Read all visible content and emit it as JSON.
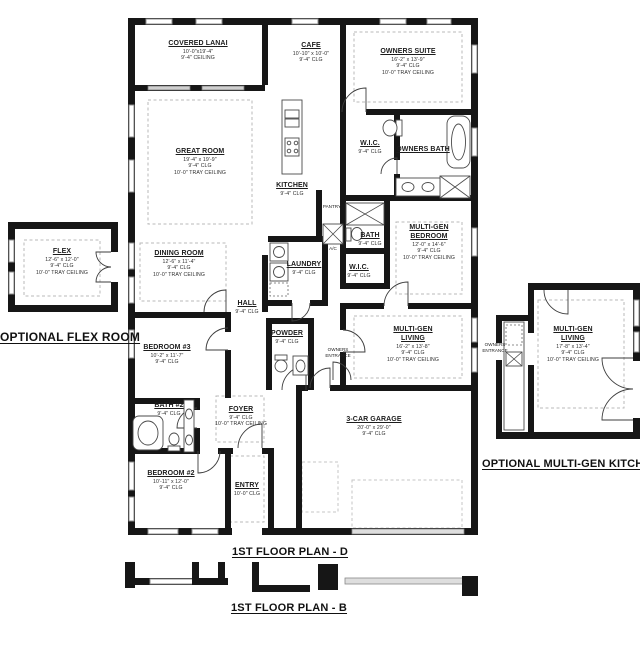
{
  "colors": {
    "wall": "#161616",
    "window_frame": "#8f8f8f",
    "dashed_tray": "#b9b9b9",
    "paper": "#ffffff"
  },
  "sections": {
    "optional_flex": "OPTIONAL FLEX ROOM",
    "optional_multigen_kitchen": "OPTIONAL MULTI-GEN KITCHEN",
    "plan_d": "1ST FLOOR PLAN - D",
    "plan_b": "1ST FLOOR PLAN - B"
  },
  "rooms": {
    "covered_lanai": {
      "name": "COVERED LANAI",
      "dims": "10'-0\"x19'-4\"",
      "clg": "9'-4\" CEILING"
    },
    "cafe": {
      "name": "CAFE",
      "dims": "10'-10\" x 10'-0\"",
      "clg": "9'-4\" CLG"
    },
    "owners_suite": {
      "name": "OWNERS SUITE",
      "dims": "16'-2\" x 13'-9\"",
      "clg": "9'-4\" CLG",
      "tray": "10'-0\" TRAY CEILING"
    },
    "great_room": {
      "name": "GREAT ROOM",
      "dims": "19'-4\" x 19'-9\"",
      "clg": "9'-4\" CLG",
      "tray": "10'-0\" TRAY CEILING"
    },
    "kitchen": {
      "name": "KITCHEN",
      "clg": "9'-4\" CLG"
    },
    "pantry": {
      "name": "PANTRY"
    },
    "owners_wic": {
      "name": "W.I.C.",
      "clg": "9'-4\" CLG"
    },
    "owners_bath": {
      "name": "OWNERS BATH"
    },
    "multigen_bedroom": {
      "name": "MULTI-GEN",
      "name2": "BEDROOM",
      "dims": "12'-0\" x 14'-6\"",
      "clg": "9'-4\" CLG",
      "tray": "10'-0\" TRAY CEILING"
    },
    "multigen_bath": {
      "name": "BATH",
      "clg": "9'-4\" CLG"
    },
    "multigen_wic": {
      "name": "W.I.C.",
      "clg": "9'-4\" CLG"
    },
    "dining_room": {
      "name": "DINING ROOM",
      "dims": "12'-6\" x 11'-4\"",
      "clg": "9'-4\" CLG",
      "tray": "10'-0\" TRAY CEILING"
    },
    "laundry": {
      "name": "LAUNDRY",
      "clg": "9'-4\" CLG"
    },
    "hall": {
      "name": "HALL",
      "clg": "9'-4\" CLG"
    },
    "powder": {
      "name": "POWDER",
      "clg": "9'-4\" CLG"
    },
    "owners_entrance": {
      "name": "OWNERS",
      "name2": "ENTRANCE"
    },
    "multigen_living": {
      "name": "MULTI-GEN",
      "name2": "LIVING",
      "dims": "16'-2\" x 13'-8\"",
      "clg": "9'-4\" CLG",
      "tray": "10'-0\" TRAY CEILING"
    },
    "bedroom3": {
      "name": "BEDROOM #3",
      "dims": "10'-2\" x 11'-7\"",
      "clg": "9'-4\" CLG"
    },
    "bath2": {
      "name": "BATH #2",
      "clg": "9'-4\" CLG"
    },
    "foyer": {
      "name": "FOYER",
      "clg": "9'-4\" CLG",
      "tray": "10'-0\" TRAY CEILING"
    },
    "bedroom2": {
      "name": "BEDROOM #2",
      "dims": "10'-11\" x 12'-0\"",
      "clg": "9'-4\" CLG"
    },
    "entry": {
      "name": "ENTRY",
      "clg": "10'-0\" CLG"
    },
    "garage": {
      "name": "3-CAR GARAGE",
      "dims": "20'-0\" x 29'-0\"",
      "clg": "9'-4\" CLG"
    },
    "flex": {
      "name": "FLEX",
      "dims": "12'-6\" x 12'-0\"",
      "clg": "9'-4\" CLG",
      "tray": "10'-0\" TRAY CEILING"
    },
    "opt_multigen_living": {
      "name": "MULTI-GEN",
      "name2": "LIVING",
      "dims": "17'-8\" x 13'-4\"",
      "clg": "9'-4\" CLG",
      "tray": "10'-0\" TRAY CEILING"
    },
    "opt_owners_entrance": {
      "name": "OWNERS",
      "name2": "ENTRANCE"
    },
    "ac_closet": {
      "name": "A/C"
    }
  }
}
